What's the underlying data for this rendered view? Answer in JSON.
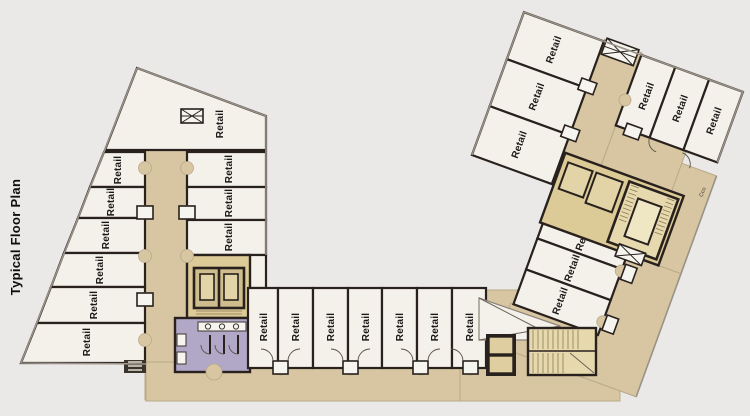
{
  "title": "Typical Floor Plan",
  "colors": {
    "background": "#eae9e7",
    "room_fill": "#f4f1ea",
    "corridor_tan": "#d8c6a2",
    "core_khaki": "#ddcb97",
    "stair_fill": "#e7d9ae",
    "restroom_purple": "#b1a7c7",
    "wall": "#28211d"
  },
  "rooms": {
    "left_wing_top": {
      "label": "Retail"
    },
    "left_wing_west": [
      {
        "label": "Retail"
      },
      {
        "label": "Retail"
      },
      {
        "label": "Retail"
      },
      {
        "label": "Retail"
      },
      {
        "label": "Retail"
      },
      {
        "label": "Retail"
      }
    ],
    "left_wing_east": [
      {
        "label": "Retail"
      },
      {
        "label": "Retail"
      },
      {
        "label": "Retail"
      }
    ],
    "bottom_row": [
      {
        "label": "Retail"
      },
      {
        "label": "Retail"
      },
      {
        "label": "Retail"
      },
      {
        "label": "Retail"
      },
      {
        "label": "Retail"
      },
      {
        "label": "Retail"
      },
      {
        "label": "Retail"
      }
    ],
    "right_wing_end": [
      {
        "label": "Retail"
      },
      {
        "label": "Retail"
      },
      {
        "label": "Retail"
      }
    ],
    "right_wing_north": [
      {
        "label": "Retail"
      },
      {
        "label": "Retail"
      },
      {
        "label": "Retail"
      }
    ],
    "right_wing_south": [
      {
        "label": "Retail"
      },
      {
        "label": "Retail"
      },
      {
        "label": "Retail"
      }
    ]
  },
  "annotations": {
    "door_tag": "Cco"
  }
}
